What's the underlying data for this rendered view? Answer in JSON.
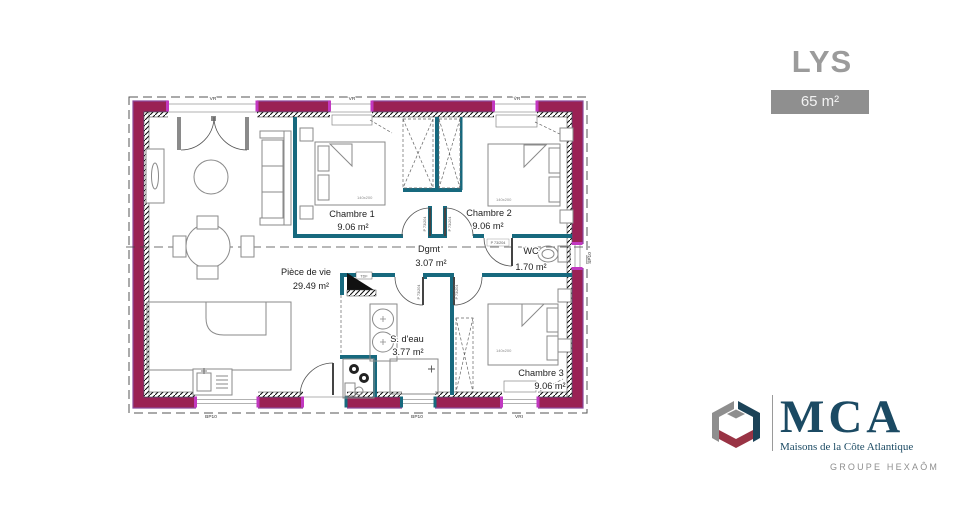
{
  "header": {
    "model_name": "LYS",
    "area_badge": "65 m²"
  },
  "plan": {
    "rooms": [
      {
        "name": "Pièce de vie",
        "area": "29.49 m²"
      },
      {
        "name": "Chambre 1",
        "area": "9.06 m²"
      },
      {
        "name": "Chambre 2",
        "area": "9.06 m²"
      },
      {
        "name": "Chambre 3",
        "area": "9.06 m²"
      },
      {
        "name": "Dgmt",
        "area": "3.07 m²"
      },
      {
        "name": "WC",
        "area": "1.70 m²"
      },
      {
        "name": "S. d'eau",
        "area": "3.77 m²"
      }
    ],
    "openings": {
      "top_1": "VR",
      "top_2": "VR",
      "top_3": "VR",
      "bottom_1": "BP10",
      "bottom_2": "BP10",
      "bottom_3": "VRI",
      "right_1": "SP10"
    },
    "doors": {
      "label": "P 73/204"
    },
    "beds": {
      "size_label": "140x200"
    },
    "electrical_panel": "TDF",
    "colors": {
      "exterior_wall": "#9A2154",
      "exterior_edge": "#8C4A9C",
      "interior_wall": "#17697E",
      "accent_jamb": "#C238C0"
    }
  },
  "brand": {
    "initials": "MCA",
    "name": "Maisons de la Côte Atlantique",
    "group": "GROUPE HEXAÔM"
  }
}
